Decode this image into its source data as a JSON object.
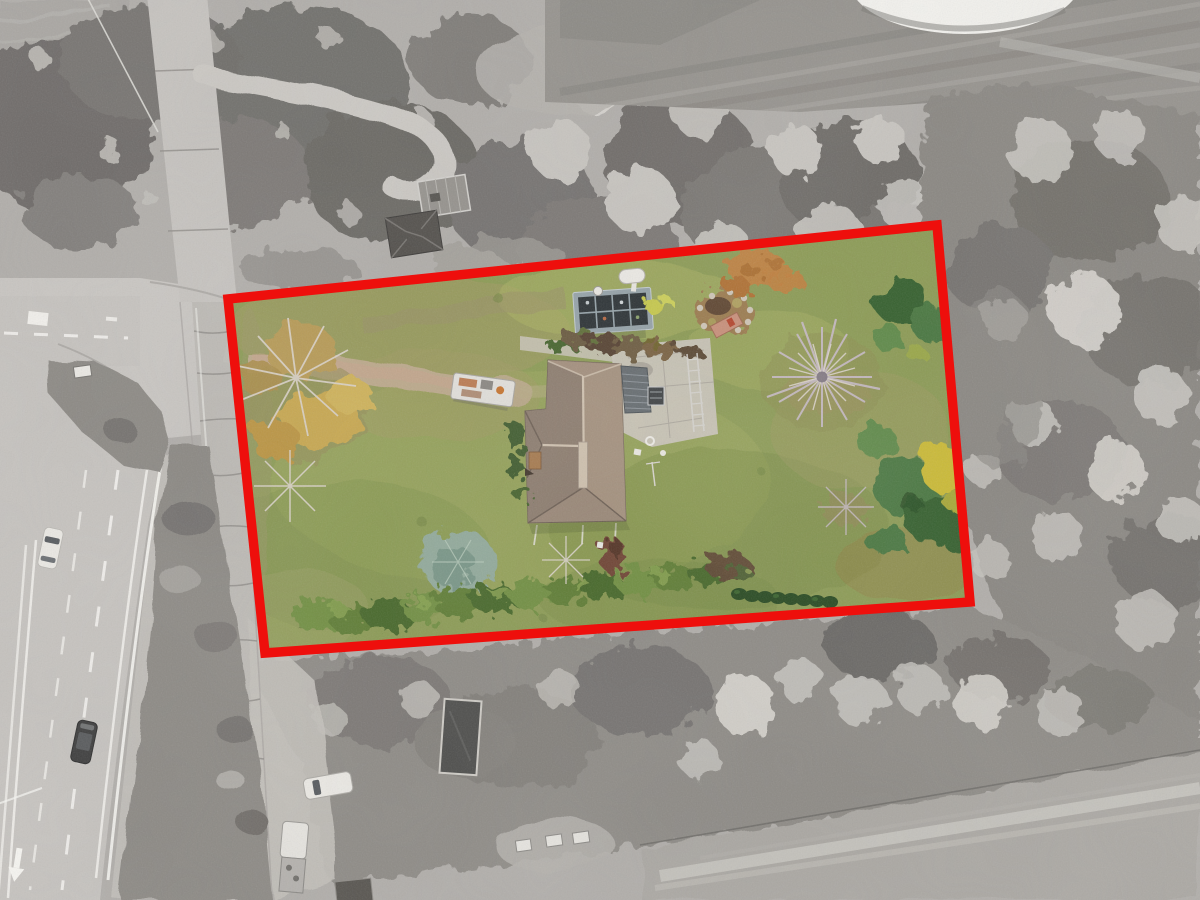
{
  "scene": {
    "title": "Aerial drone photograph of a rural lot outlined in red; lot interior in color, surroundings desaturated to grayscale",
    "style": "photograph",
    "effect": "color-pop property highlight"
  },
  "boundary": {
    "points": "228,299 937,225 970,602 265,653",
    "color": "#ee0f0c",
    "stroke_width": 9.5,
    "label": "property-line-outline"
  },
  "palette": {
    "base": "#b1aeaa",
    "road": "#c6c3bf",
    "roadNarrow": "#bdbab5",
    "junction": "#c9c6c2",
    "shoulder": "#c3c0ba",
    "marking": "#f6f5f1",
    "roadEdge": "#a19e9a",
    "crack": "#8e8b87",
    "field": "#95928d",
    "fieldLight": "#aba8a3",
    "fieldDark": "#827f7b",
    "bunker": "#f3f2ee",
    "treeDark": "#6e6b67",
    "treeMid": "#8a8782",
    "treeLight": "#c7c4bf",
    "speckle": "#d8d5cf",
    "scrub": "#8c8984",
    "grass": "#8c9b55",
    "grassLight": "#a9b164",
    "grassDark": "#6f8440",
    "grassBrown": "#a39a63",
    "dirt": "#bca98b",
    "dirtPink": "#c7a58e",
    "concrete": "#c9c4b9",
    "roofMain": "#9a8878",
    "roofLightFace": "#a6937f",
    "roofShade": "#897a6d",
    "roofRidge": "#d0c2b0",
    "roofEdge": "#6e6055",
    "garage": "#666c70",
    "garageRib": "#90979c",
    "ghFrame": "#95a2a8",
    "ghCell": "#2c3235",
    "tank": "#eceae5",
    "soil": "#9c7c50",
    "stone": "#cfc6b7",
    "lumber": "#c9907b",
    "lumberRed": "#b5452e",
    "orange": "#c07f3e",
    "orangeDark": "#9e6227",
    "branch": "#c2b7bc",
    "branchLight": "#dad3ca",
    "branchCore": "#6f6572",
    "conifer1": "#35602e",
    "conifer2": "#497741",
    "conifer3": "#5f8a49",
    "coniferYellow": "#ccbb34",
    "spruce": "#91a99a",
    "spruceDark": "#739182",
    "hedge1": "#5e7d34",
    "hedge2": "#718f42",
    "hedge3": "#47672c",
    "hedgeLight": "#88a251",
    "yew": "274920",
    "maroon": "#6f4535",
    "maroonDark": "#4e2f26",
    "vehWhite": "#ebe9e4",
    "vehDark": "#3a3a3a",
    "glass": "#565a5e",
    "trailerDark": "#4e4e4c",
    "shedWhite": "#e6e4df",
    "boxGray": "#9b9b97",
    "structGray": "#96938e",
    "structDark": "#514e4a",
    "structLight": "#d7d5d1",
    "shadowGreen": "#5f6a3a",
    "tanBox": "#a67a4e",
    "boundary": "#ee0f0c"
  },
  "objects": {
    "lot": [
      "hip-roof-house",
      "metal-awning-roof",
      "concrete-patio",
      "gravel-driveway",
      "utility-trailer-with-scrap",
      "cold-frame-greenhouse",
      "propane-tank",
      "round-garden-bed",
      "golden-autumn-tree",
      "large-bare-tree",
      "blue-spruce",
      "conifer-group",
      "yellow-tree",
      "hedge-row",
      "yew-bush-row",
      "maroon-shrub",
      "lawn"
    ],
    "surroundings": [
      "divided-highway-with-lane-markings",
      "frontage-road",
      "road-junction",
      "grass-median-island",
      "white-car-driving",
      "dark-car-driving",
      "parked-white-car",
      "parked-rv-truck",
      "open-dark-trailer",
      "small-white-sheds",
      "wood-deck",
      "hip-roof-shed",
      "dirt-turnaround-loop",
      "sand-bunker",
      "mowed-field-stripes",
      "tree-groves",
      "field-with-vehicle-tracks"
    ]
  }
}
